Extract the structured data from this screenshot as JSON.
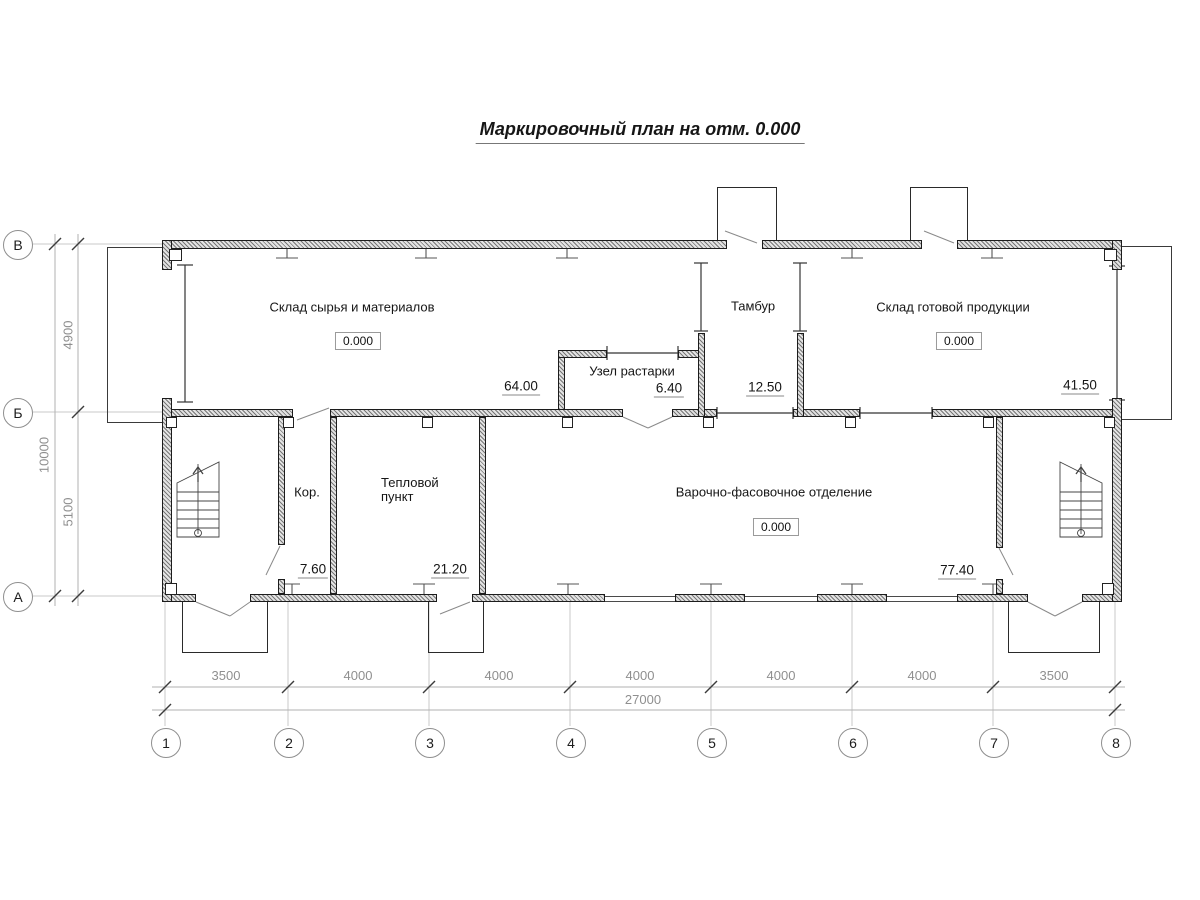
{
  "title": "Маркировочный план на отм. 0.000",
  "rooms": {
    "raw_materials_storage": {
      "name": "Склад сырья и материалов",
      "elevation": "0.000",
      "mark": "64.00"
    },
    "unpacking_unit": {
      "name": "Узел растарки",
      "mark": "6.40"
    },
    "vestibule": {
      "name": "Тамбур",
      "mark": "12.50"
    },
    "finished_goods_storage": {
      "name": "Склад готовой продукции",
      "elevation": "0.000",
      "mark": "41.50"
    },
    "corridor": {
      "name": "Кор.",
      "mark": "7.60"
    },
    "heating_station": {
      "name_line1": "Тепловой",
      "name_line2": "пункт",
      "mark": "21.20"
    },
    "cooking_packing": {
      "name": "Варочно-фасовочное отделение",
      "elevation": "0.000",
      "mark": "77.40"
    }
  },
  "axes": {
    "rows": [
      {
        "label": "В"
      },
      {
        "label": "Б"
      },
      {
        "label": "А"
      }
    ],
    "cols": [
      {
        "label": "1"
      },
      {
        "label": "2"
      },
      {
        "label": "3"
      },
      {
        "label": "4"
      },
      {
        "label": "5"
      },
      {
        "label": "6"
      },
      {
        "label": "7"
      },
      {
        "label": "8"
      }
    ]
  },
  "dimensions": {
    "left": {
      "spans": [
        {
          "value": "4900"
        },
        {
          "value": "5100"
        }
      ],
      "total": "10000"
    },
    "bottom": {
      "spans": [
        {
          "value": "3500"
        },
        {
          "value": "4000"
        },
        {
          "value": "4000"
        },
        {
          "value": "4000"
        },
        {
          "value": "4000"
        },
        {
          "value": "4000"
        },
        {
          "value": "3500"
        }
      ],
      "total": "27000"
    }
  }
}
